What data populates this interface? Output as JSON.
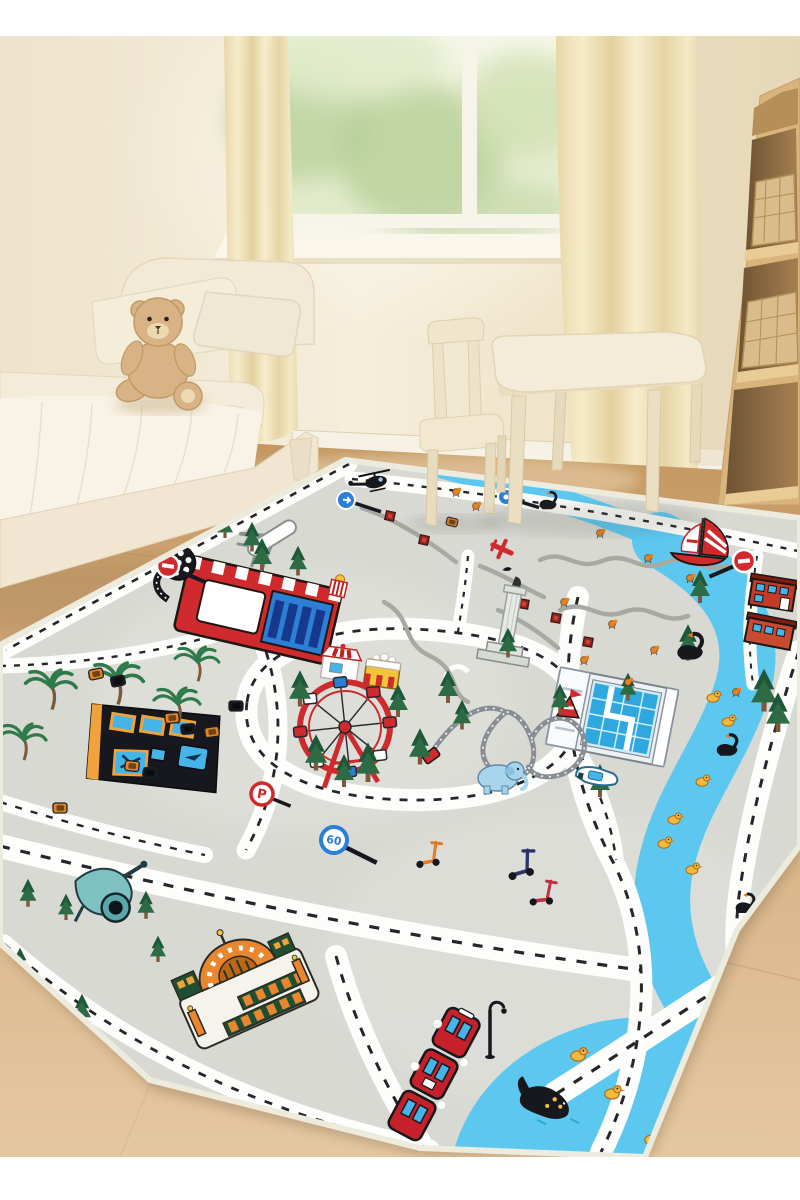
{
  "scene": {
    "type": "product photo",
    "description": "Children's bedroom with cream toddler bed, teddy bear, window with garden view, sheer curtains, kids table and chair, wooden stair shelf with wicker baskets, and a large grey city-road play rug with white roads, blue river, amusement park and town landmarks.",
    "labels": {
      "speed_sign": "60",
      "parking_sign": "P"
    },
    "objects": [
      "window with garden view",
      "sheer cream curtains",
      "toddler bed",
      "pillows",
      "teddy bear plush",
      "kids table",
      "kids chair",
      "stair shelf with wicker baskets",
      "city road play rug",
      "cinema building with film reel",
      "popcorn stand",
      "ticket booth",
      "snack stand",
      "ferris wheel",
      "roller coaster with flag tent",
      "victory column",
      "swimming stadium",
      "black school building",
      "red brick houses",
      "orange mosque",
      "red train",
      "street lamp",
      "sailboat",
      "motorboat",
      "helicopter",
      "white airplane",
      "red toy plane",
      "blue elephant",
      "black whale",
      "black swans",
      "yellow ducks",
      "kick scooters",
      "toy cannon",
      "palm trees",
      "pine trees",
      "toy cars",
      "winding river",
      "stop signs",
      "speed limit sign",
      "parking sign",
      "benches"
    ]
  },
  "colors": {
    "wall": "#f1e7d2",
    "wallGlow": "#fdf8ea",
    "wallShade": "#e6d8ba",
    "white": "#ffffff",
    "curtain": "#f0e2bc",
    "curtainDeep": "#e0cd9c",
    "sill": "#faf6ea",
    "glassTop": "#f2f5e0",
    "glassGreen": "#d6e3ba",
    "treeBlob1": "#b2ca8e",
    "treeBlob2": "#c9dba6",
    "floor": "#c89c69",
    "floorMid": "#d7b286",
    "floorLight": "#e3c7a0",
    "plank": "#b9905c",
    "wood": "#d9b47c",
    "woodLip": "#e9cb96",
    "woodDark": "#9a7848",
    "woodDeep": "#6e5333",
    "basket": "#d9bc8a",
    "basketLine": "#b08e58",
    "bedFrame": "#f2e9d6",
    "bedEdge": "#e2d4b6",
    "mattress": "#f8f3e6",
    "pillow": "#f3edda",
    "teddy": "#d9b386",
    "teddyShade": "#c09a66",
    "teddyMuzzle": "#ecd9b2",
    "rug": "#d8d9d3",
    "rugLight": "#e2e3dd",
    "rugEdge": "#edeade",
    "road": "#fdfdfb",
    "dash": "#26262a",
    "pathGray": "#a6aaa2",
    "river": "#5cc8f0",
    "pine": "#2c6b44",
    "pineDark": "#1e573a",
    "trunk": "#7a5a3c",
    "palm": "#2e7a4a",
    "red": "#cf2b2e",
    "blue": "#2b7fd4",
    "navyWin": "#16398c",
    "winBlue": "#45b4e8",
    "black": "#17181d",
    "orange": "#f0a23c",
    "carOrange": "#e08428",
    "houseRed": "#c23a28",
    "mosqOrange": "#e8872f",
    "mosqGreen": "#1f4e33",
    "gold": "#f2c43c",
    "trainRed": "#c6202a",
    "duck": "#f2b93c",
    "eleBlue": "#a8d4ec",
    "stadium": "#eef1f3",
    "poolBlue": "#2fa8e0",
    "track": "#878d92",
    "scootOrange": "#e07b28",
    "scootNavy": "#2b3566",
    "scootRed": "#c03040",
    "teal": "#7fc0c2",
    "tealDark": "#203c44",
    "signBlue": "#2b7fd4",
    "benchRed": "#8a2822"
  }
}
